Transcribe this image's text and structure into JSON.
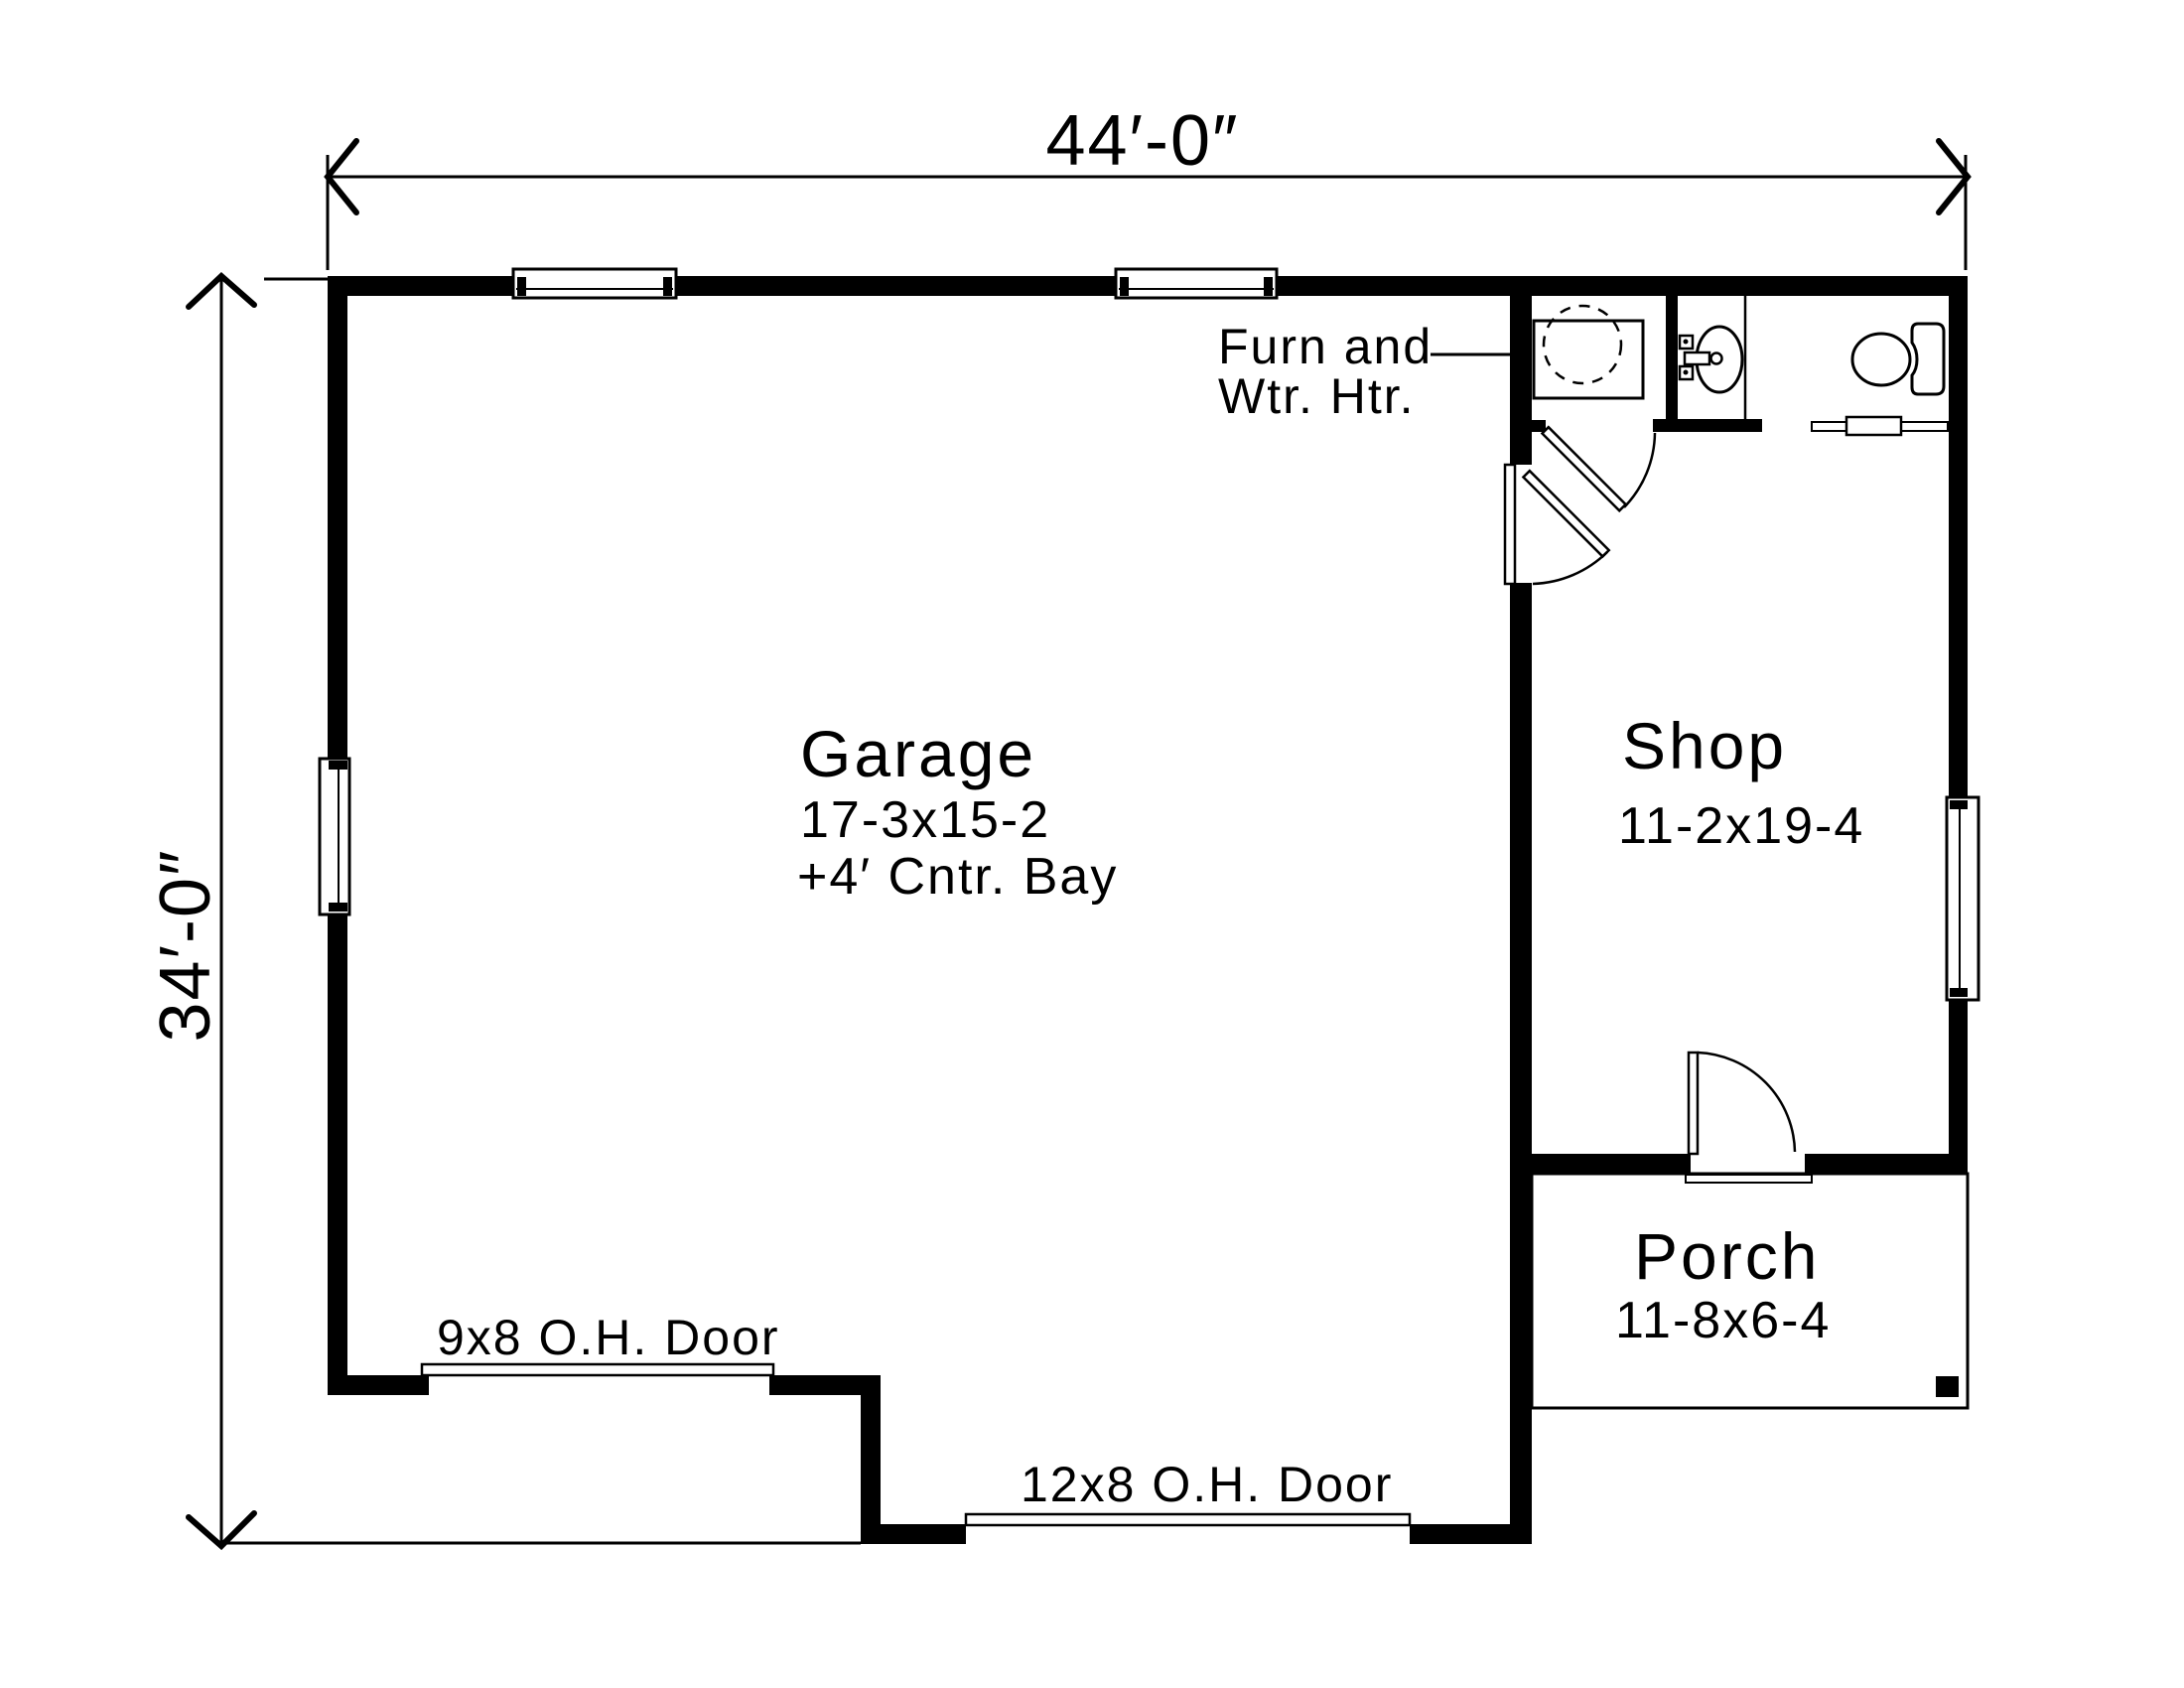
{
  "drawing_title": "Garage with Shop and Porch floor plan",
  "colors": {
    "ink": "#000000",
    "paper": "#ffffff"
  },
  "dimensions": {
    "overall_width": "44′-0″",
    "overall_depth": "34′-0″"
  },
  "rooms": {
    "garage": {
      "name": "Garage",
      "size": "17-3x15-2",
      "note": "+4′ Cntr. Bay"
    },
    "shop": {
      "name": "Shop",
      "size": "11-2x19-4"
    },
    "porch": {
      "name": "Porch",
      "size": "11-8x6-4"
    }
  },
  "annotations": {
    "furnace_line1": "Furn and",
    "furnace_line2": "Wtr. Htr.",
    "oh_door_small": "9x8 O.H. Door",
    "oh_door_large": "12x8 O.H. Door"
  },
  "fixtures": [
    "furnace-water-heater",
    "bathroom-sink",
    "toilet",
    "closet-shelf-rod",
    "window-top-left",
    "window-top-right",
    "window-left-wall",
    "window-right-wall",
    "door-furnace-closet",
    "door-garage-to-shop",
    "door-shop-to-porch",
    "porch-post"
  ]
}
